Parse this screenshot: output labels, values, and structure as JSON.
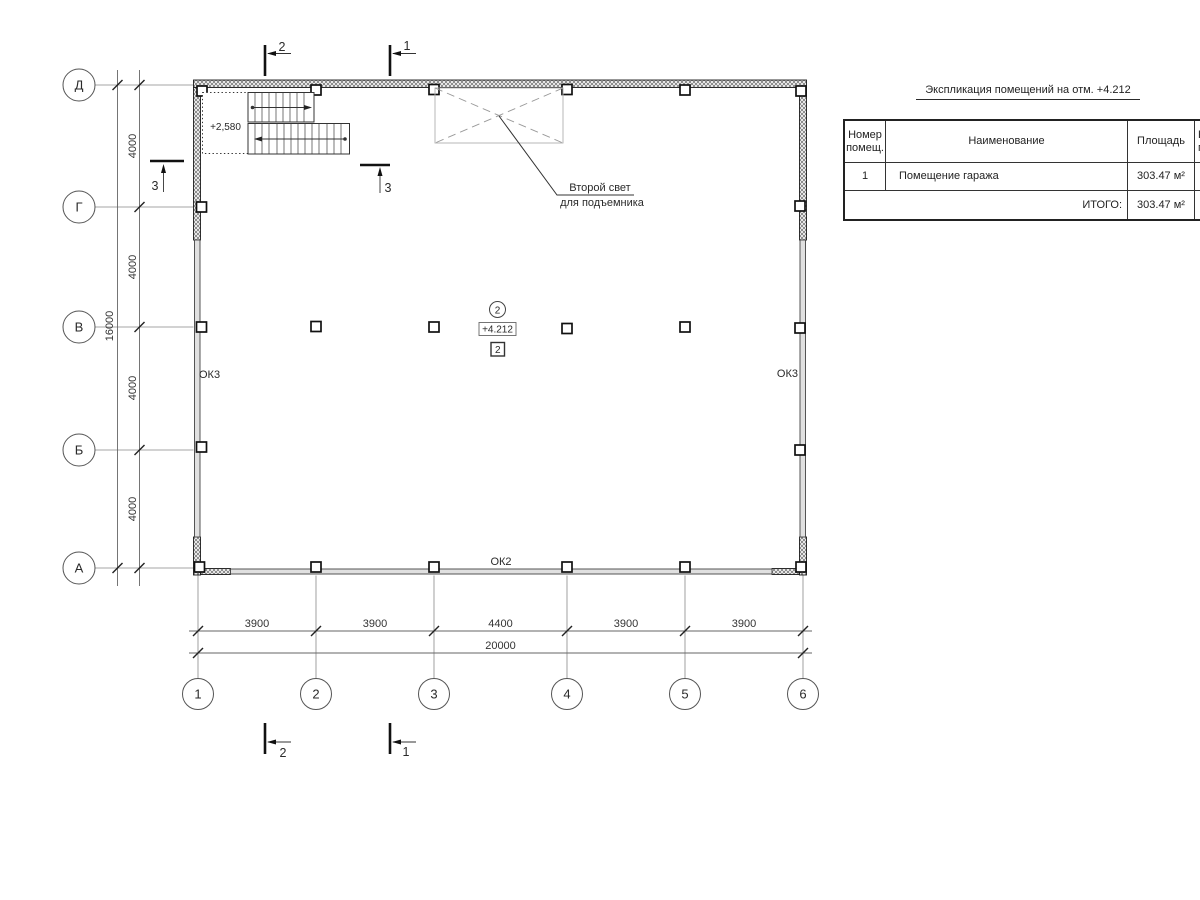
{
  "schedule": {
    "title": "Экспликация помещений на отм. +4.212",
    "header": {
      "col_num_line1": "Номер",
      "col_num_line2": "помещ.",
      "col_name": "Наименование",
      "col_area": "Площадь",
      "col_cut_line1": "К",
      "col_cut_line2": "г"
    },
    "row1": {
      "num": "1",
      "name": "Помещение гаража",
      "area": "303.47 м²"
    },
    "total": {
      "label": "ИТОГО:",
      "area": "303.47 м²"
    }
  },
  "axes": {
    "left": [
      "Д",
      "Г",
      "В",
      "Б",
      "А"
    ],
    "bottom": [
      "1",
      "2",
      "3",
      "4",
      "5",
      "6"
    ]
  },
  "dims": {
    "bottom": [
      "3900",
      "3900",
      "4400",
      "3900",
      "3900"
    ],
    "bottom_total": "20000",
    "left": [
      "4000",
      "4000",
      "4000",
      "4000"
    ],
    "left_total": "16000"
  },
  "labels": {
    "window_left": "ОК3",
    "window_right": "ОК3",
    "window_bottom": "ОК2",
    "stair_elevation": "+2,580",
    "room_number": "2",
    "elevation_mark": "+4.212",
    "level_box": "2",
    "leader_line1": "Второй свет",
    "leader_line2": "для подъемника"
  },
  "sections": {
    "top_left": "2",
    "top_right": "1",
    "bottom_left": "2",
    "bottom_right": "1",
    "side_left": "3",
    "side_right": "3"
  }
}
